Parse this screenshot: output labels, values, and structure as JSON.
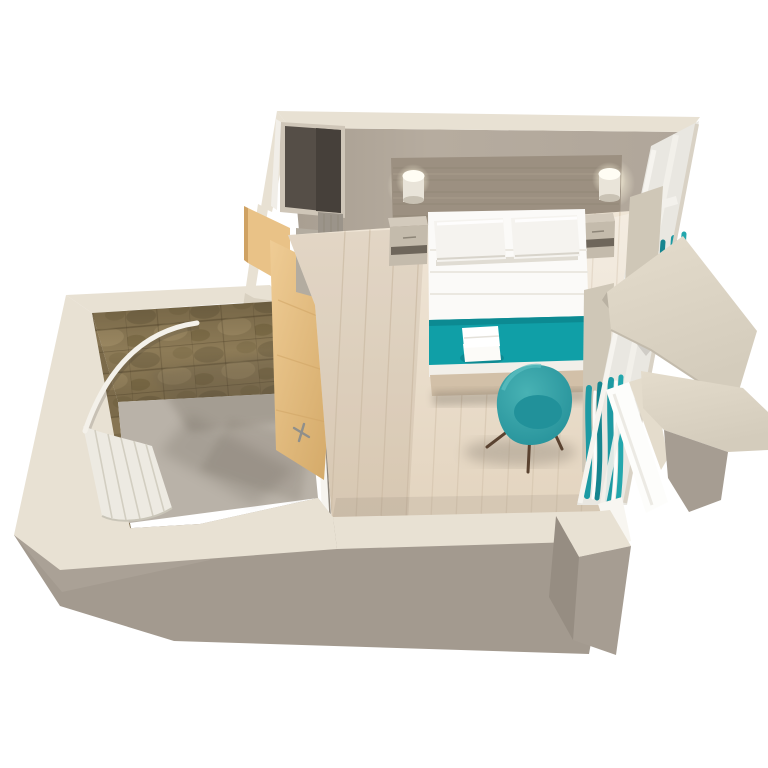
{
  "scene": {
    "type": "3d-floorplan-render",
    "rooms": {
      "bedroom": {
        "objects": [
          "headboard-panel",
          "wall-lamp-left",
          "wall-lamp-right",
          "nightstand-left",
          "nightstand-right",
          "double-bed",
          "pillow-left",
          "pillow-right",
          "teal-bed-runner",
          "folded-towels",
          "bed-base",
          "teal-tub-chair",
          "open-closet-niche",
          "wood-floor",
          "window-wall",
          "teal-window-curtains",
          "sheer-curtains",
          "mirror-panel"
        ]
      },
      "bathroom": {
        "objects": [
          "marble-tile-walls",
          "grey-floor",
          "curved-shower-rod",
          "shower-curtain",
          "wood-door-open"
        ]
      },
      "exterior": {
        "objects": [
          "cream-wall-tops",
          "grey-wall-faces",
          "balcony-slab-upper",
          "balcony-slab-lower",
          "corner-pillar",
          "entrance-door"
        ]
      }
    }
  },
  "colors": {
    "background": "#ffffff",
    "wall_top_cream": "#e8e1d3",
    "wall_cream_dark": "#d9d1c1",
    "wall_inner": "#b2a89c",
    "wall_exterior_grey": "#a69d92",
    "wall_exterior_grey_dark": "#968d82",
    "floor_wood": "#ecdfcd",
    "floor_plank": "#d8c8b2",
    "bath_floor": "#b9b2a8",
    "tile_base": "#8d7b57",
    "tile_dark": "#6d5f41",
    "tile_light": "#a6936c",
    "wood_door": "#e9c287",
    "wood_door_dark": "#cfa263",
    "headboard_wood": "#9c9081",
    "headboard_grain": "#8b8071",
    "nightstand_top": "#d3cabc",
    "nightstand_front": "#c4bbac",
    "nightstand_slot": "#6e665b",
    "bed_white": "#fbfaf8",
    "pillow_white": "#f5f3ef",
    "teal": "#109fa7",
    "teal_chair": "#2fa0a6",
    "teal_chair_seat": "#21919a",
    "teal_curtain": "#1d9aa3",
    "glass": "#e9e7e1",
    "frame_white": "#f6f4ef",
    "mullion": "#d9d2c5",
    "pier_beige": "#cfc7b7",
    "balcony_cream": "#ded6c6",
    "mirror_white": "#fdfdfb",
    "closet_dark": "#554e47",
    "closet_dark2": "#46403a",
    "closet_frame": "#cfc6b8",
    "column_grey": "#9b948a",
    "panel_grey": "#b3aca0",
    "curtain_shower": "#edeae2",
    "leg_brown": "#5a4331",
    "base_wood": "#d2c0a8",
    "towel_white": "#fcfbf8",
    "shadow": "#6f6557"
  },
  "floor_planks": {
    "count": 12,
    "start_x": 345,
    "spacing": 25,
    "lean": 14,
    "bottom_y": 519
  }
}
